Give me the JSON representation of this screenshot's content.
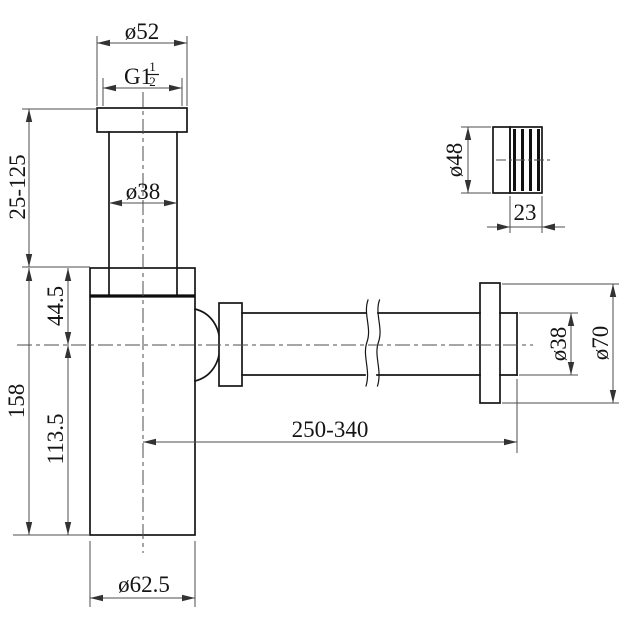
{
  "drawing": {
    "type": "technical-dimension-drawing",
    "part": "bottle trap siphon with wall outlet pipe and threaded adapter",
    "colors": {
      "background": "#ffffff",
      "outline": "#161616",
      "dimension_lines": "#4d4d4d",
      "text": "#141414"
    }
  },
  "labels": {
    "cap_diameter": "ø52",
    "thread_base": "G1",
    "thread_numerator": "1",
    "thread_denominator": "2",
    "inlet_tube_diameter": "ø38",
    "inlet_adjust_range": "25-125",
    "flange_to_axis": "44.5",
    "body_height": "158",
    "axis_to_bottom": "113.5",
    "body_diameter": "ø62.5",
    "outlet_length_range": "250-340",
    "outlet_pipe_diameter": "ø38",
    "wall_flange_diameter": "ø70",
    "adapter_diameter": "ø48",
    "adapter_length": "23"
  }
}
